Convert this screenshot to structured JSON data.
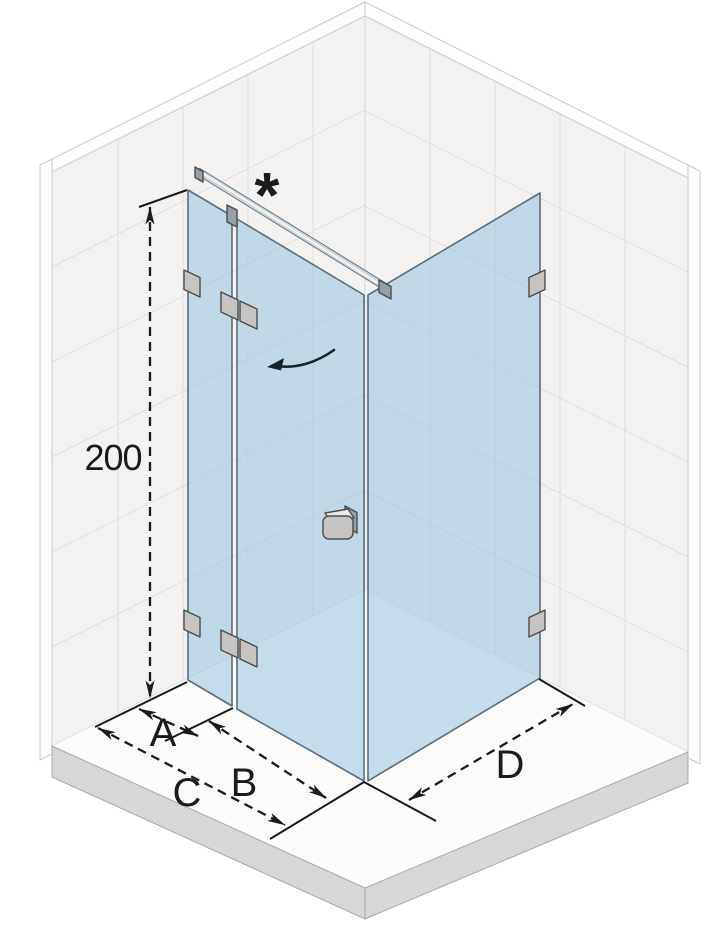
{
  "labels": {
    "height_dimension": "200",
    "dim_a": "A",
    "dim_b": "B",
    "dim_c": "C",
    "dim_d": "D",
    "footnote_marker": "*"
  },
  "colors": {
    "wall_fill": "#f3f2f1",
    "floor_fill": "#fcfcfb",
    "slab_fill": "#d8d7d5",
    "glass_fill": "#9cc6e0",
    "glass_edge": "#5a6d7c",
    "chrome_light": "#ccd4d9",
    "metal_fill": "#c6c4c2",
    "metal_dark": "#95a0a7",
    "dimension_color": "#1b1b1b"
  }
}
